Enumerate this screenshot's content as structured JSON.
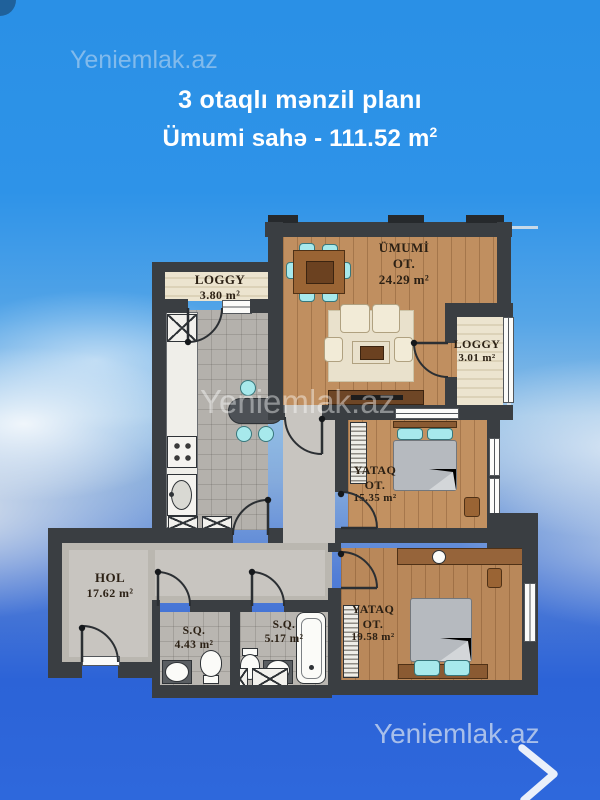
{
  "header": {
    "watermark": "Yeniemlak.az",
    "title": "3 otaqlı mənzil planı",
    "subtitle": "Ümumi sahə - 111.52 m",
    "subtitle_sup": "2"
  },
  "plan": {
    "watermark": "Yeniemlak.az",
    "rooms": {
      "loggy_top": {
        "name": "LOGGY",
        "area": "3.80 m²"
      },
      "living": {
        "name": "ÜMUMİ",
        "name2": "OT.",
        "area": "24.29 m²"
      },
      "loggy_right": {
        "name": "LOGGY",
        "area": "3.01 m²"
      },
      "bedroom1": {
        "name": "YATAQ",
        "name2": "OT.",
        "area": "15.35 m²"
      },
      "hol": {
        "name": "HOL",
        "area": "17.62 m²"
      },
      "sq_small": {
        "name": "S.Q.",
        "area": "4.43 m²"
      },
      "sq_big": {
        "name": "S.Q.",
        "area": "5.17 m²"
      },
      "bedroom2": {
        "name": "YATAQ",
        "name2": "OT.",
        "area": "19.58 m²"
      }
    }
  },
  "footer": {
    "brand": "Yeniemlak.az",
    "next_icon": "chevron-right"
  },
  "colors": {
    "sky_top": "#2a90e6",
    "sky_bottom": "#2b63d8",
    "wall": "#3a3e42",
    "wood_floor": "#bd8c5e",
    "tile_floor": "#b4b1ac",
    "hall_floor": "#c8c5c0",
    "loggia_floor": "#e9e1cb",
    "accent_teal": "#a7e9ec",
    "label_text": "#2b2014",
    "title_text": "#ffffff"
  }
}
